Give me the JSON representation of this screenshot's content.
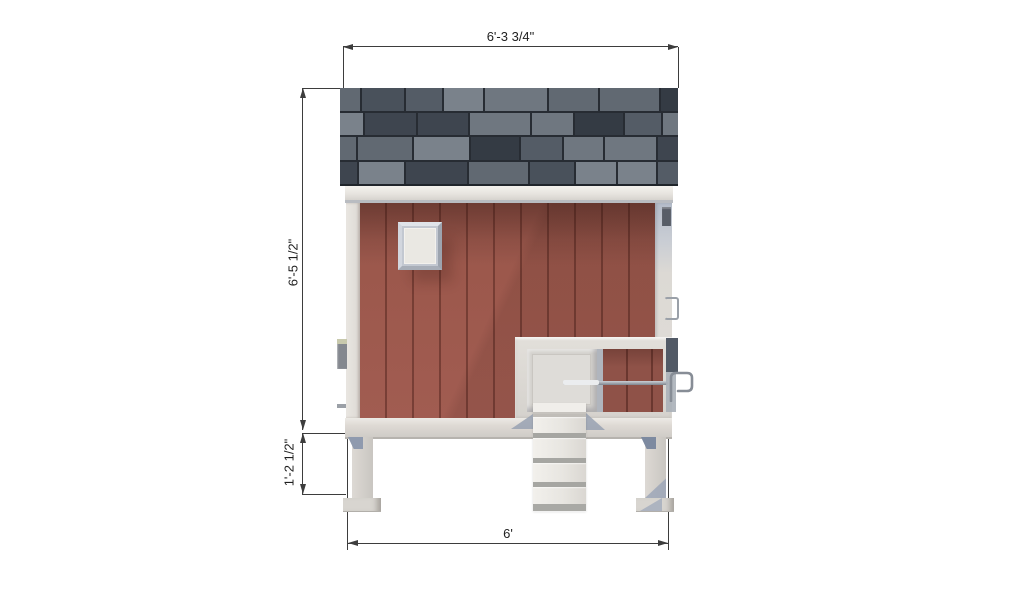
{
  "meta": {
    "drawing_type": "architectural side elevation",
    "subject": "small raised coop with shingle roof, vertical siding, access door and ramp"
  },
  "annotations": {
    "dim_top": "6'-3 3/4\"",
    "dim_left_upper": "6'-5 1/2\"",
    "dim_left_lower": "1'-2 1/2\"",
    "dim_bottom": "6'"
  },
  "colors": {
    "background": "#ffffff",
    "dimension_line": "#3d3d3d",
    "siding_red": "#9c584c",
    "siding_red_dark": "#8a4e44",
    "siding_batten": "#774138",
    "trim_white": "#e5e2dd",
    "trim_shadow": "#c7c5c0",
    "bracket_gray_blue": "#8f9aae",
    "tread_gray": "#a6a6a2",
    "rod_gray": "#8a9099",
    "hardware_gray": "#575d67",
    "roof_gap": "#272c33",
    "roof_palette": [
      "#343b44",
      "#3e454f",
      "#49515b",
      "#545c66",
      "#616972",
      "#6f7780",
      "#7a828b"
    ]
  }
}
